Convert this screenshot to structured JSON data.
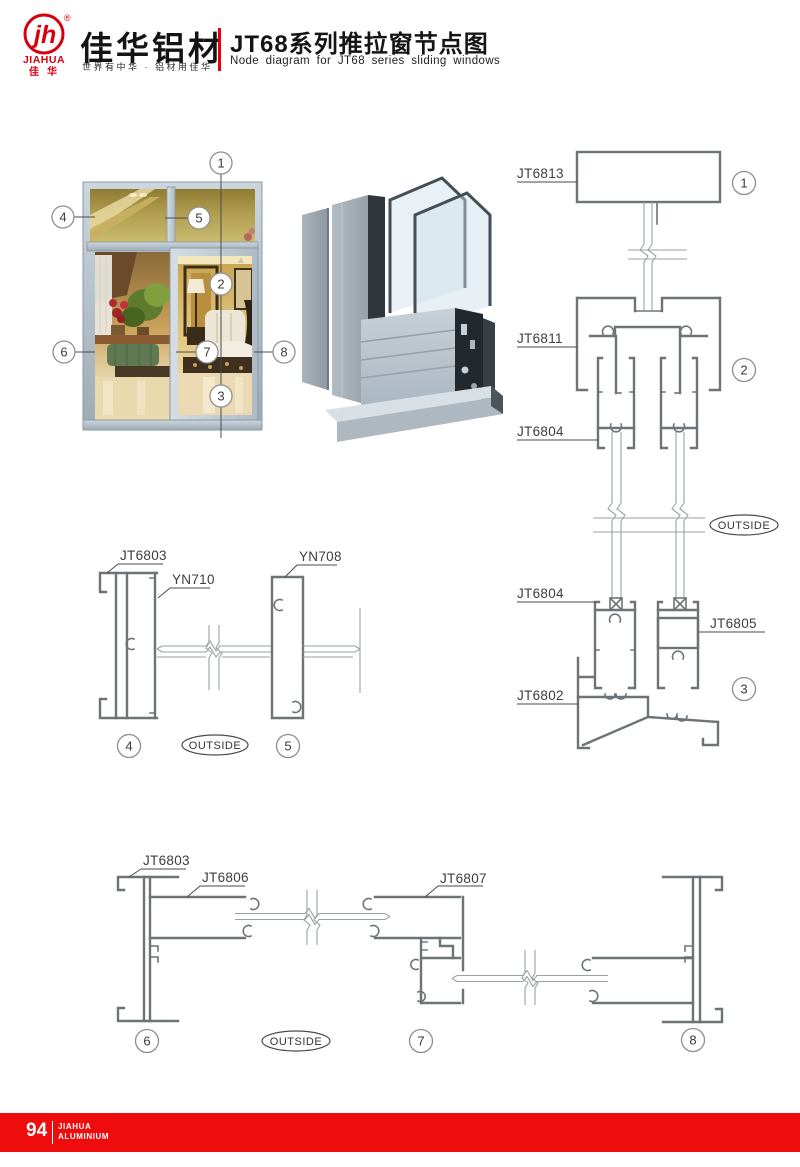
{
  "header": {
    "logo": {
      "monogram": "jh",
      "reg_mark": "®",
      "brand_en": "JIAHUA",
      "brand_cn": "佳华"
    },
    "brand_title": "佳华铝材",
    "tagline": "世界有中华 · 铝材用佳华",
    "title_cn": "JT68系列推拉窗节点图",
    "title_en": "Node diagram for JT68 series sliding windows"
  },
  "window_figure": {
    "callouts": {
      "n1": "1",
      "n2": "2",
      "n3": "3",
      "n4": "4",
      "n5": "5",
      "n6": "6",
      "n7": "7",
      "n8": "8"
    }
  },
  "details": {
    "right": {
      "jt6813": "JT6813",
      "jt6811": "JT6811",
      "jt6804_top": "JT6804",
      "jt6804_bottom": "JT6804",
      "jt6805": "JT6805",
      "jt6802": "JT6802",
      "outside": "OUTSIDE",
      "c1": "1",
      "c2": "2",
      "c3": "3"
    },
    "mid": {
      "jt6803": "JT6803",
      "yn710": "YN710",
      "yn708": "YN708",
      "outside": "OUTSIDE",
      "c4": "4",
      "c5": "5"
    },
    "bottom": {
      "jt6803": "JT6803",
      "jt6806": "JT6806",
      "jt6807": "JT6807",
      "outside": "OUTSIDE",
      "c6": "6",
      "c7": "7",
      "c8": "8"
    }
  },
  "footer": {
    "page_number": "94",
    "brand_line1": "JIAHUA",
    "brand_line2": "ALUMINIUM"
  },
  "colors": {
    "accent": "#e60012",
    "footer_bar": "#ee0c0c",
    "drawing_line": "#6d7377",
    "label_text": "#3d3d3d"
  }
}
